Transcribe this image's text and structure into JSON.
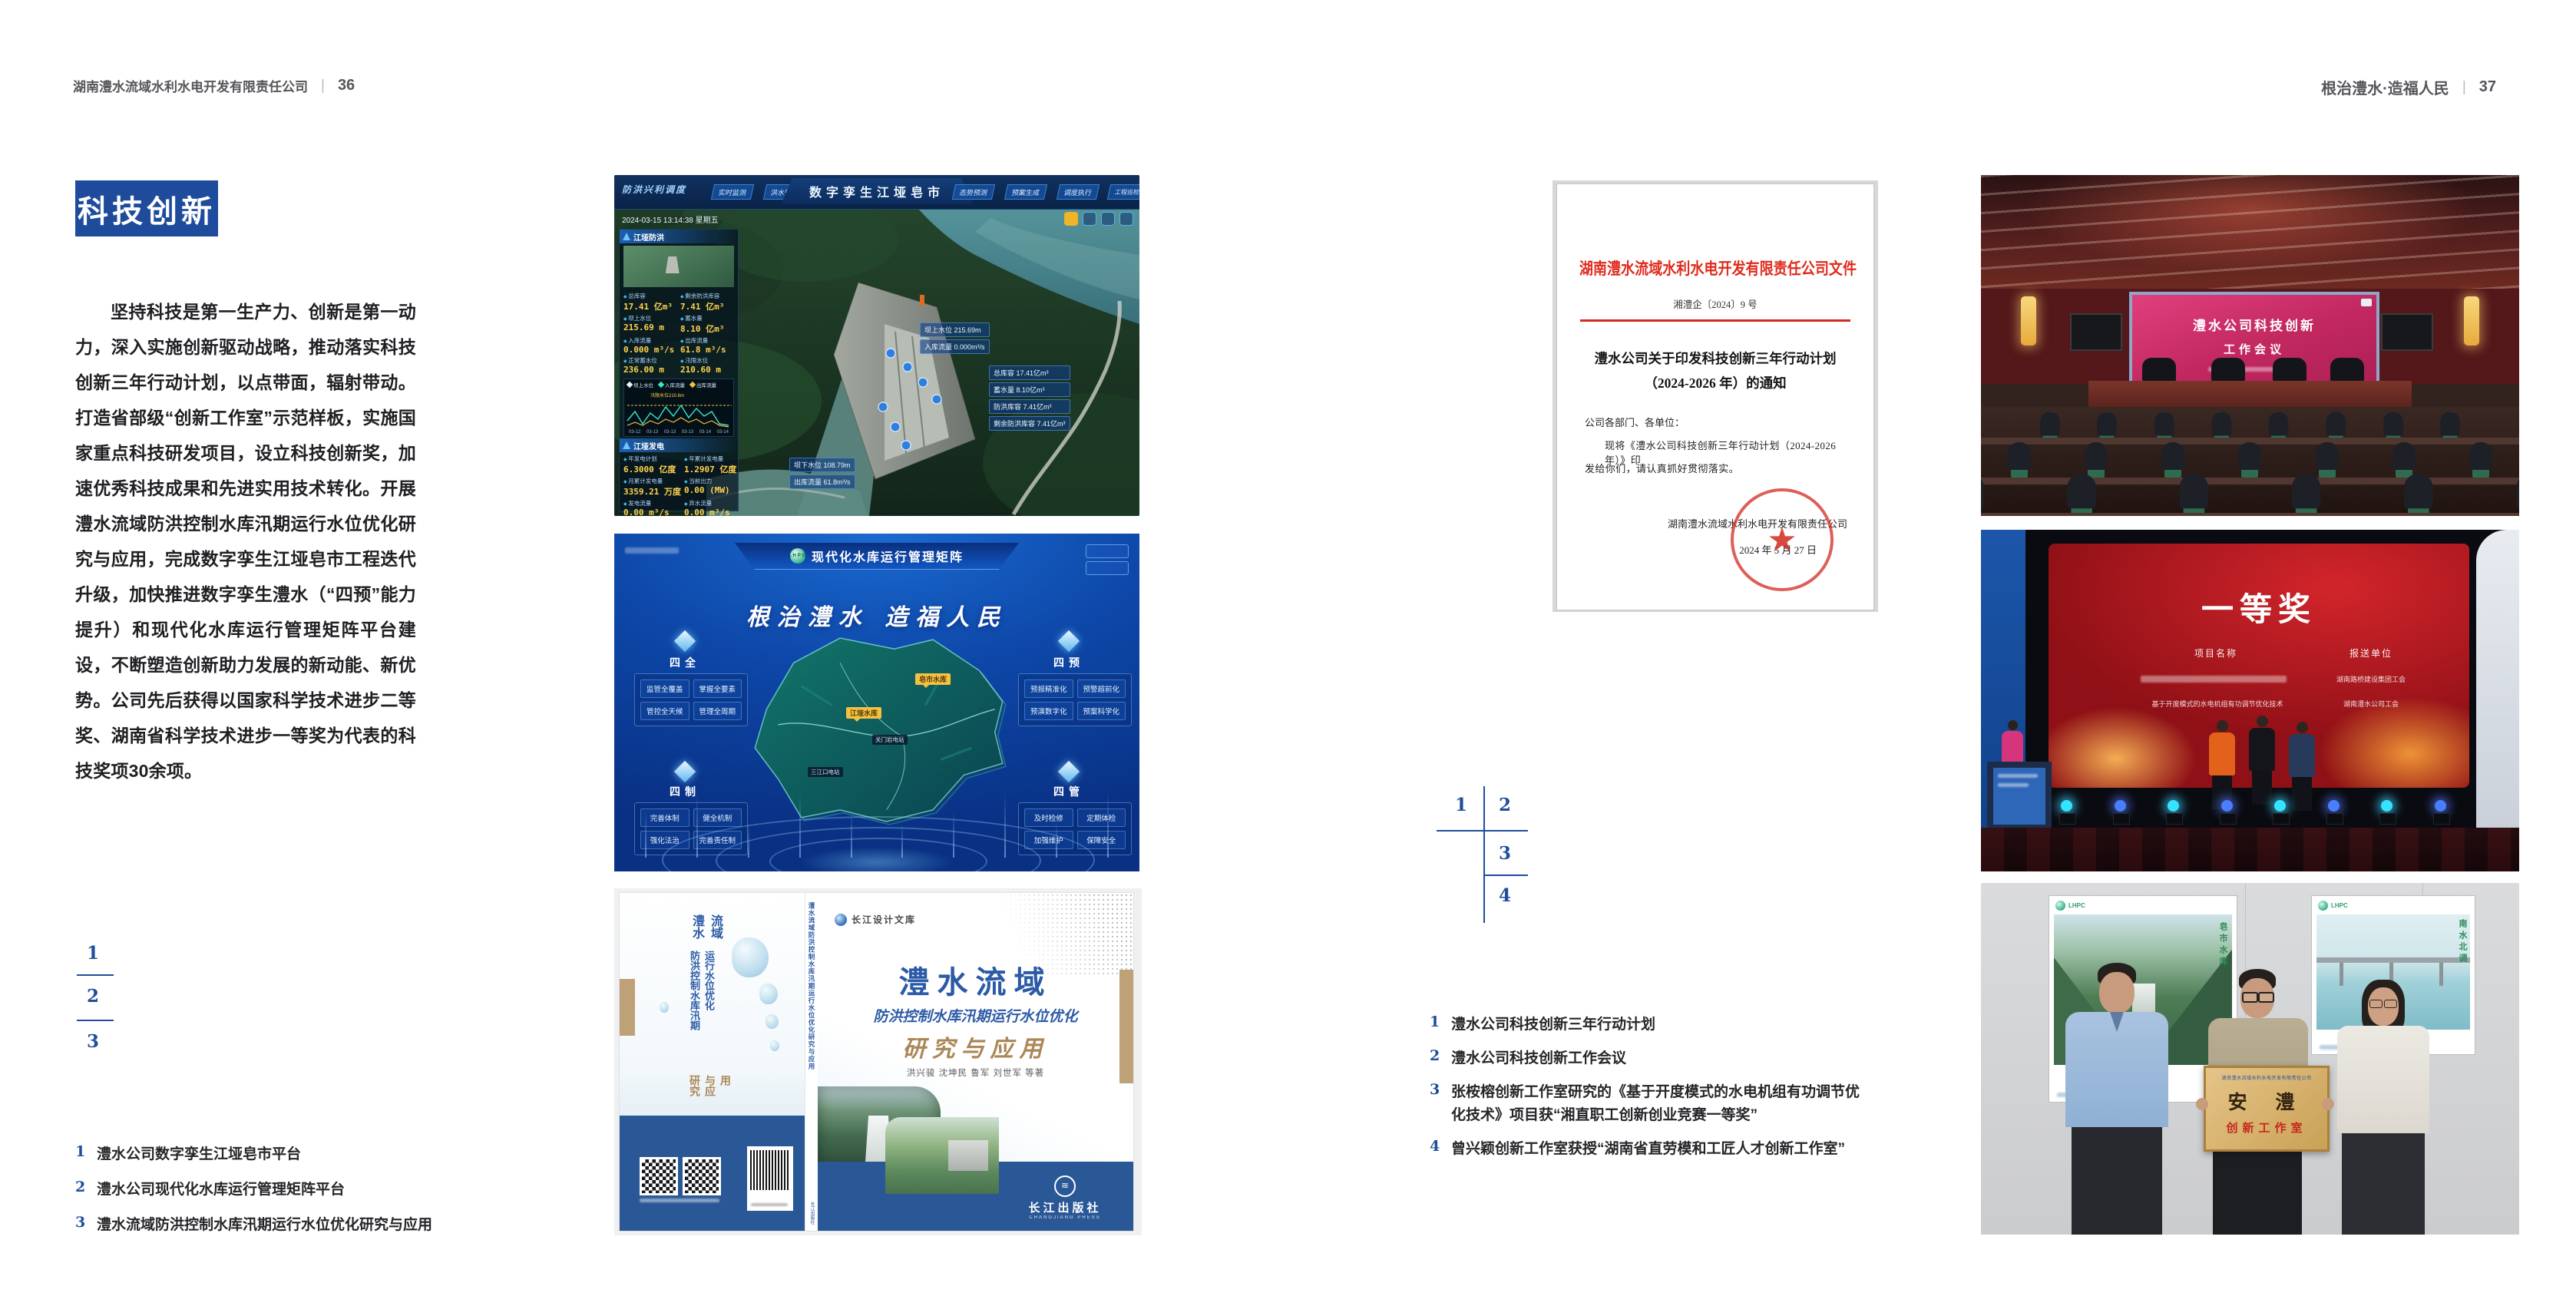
{
  "colors": {
    "accent_blue": "#1e4b9c",
    "index_blue": "#1f4e9a",
    "doc_red": "#d5281e",
    "book_tan": "#ab8757"
  },
  "header": {
    "left_company": "湖南澧水流域水利水电开发有限责任公司",
    "left_page_no": "36",
    "divider": "|",
    "right_slogan": "根治澧水·造福人民",
    "right_page_no": "37"
  },
  "section": {
    "title": "科技创新",
    "body": "坚持科技是第一生产力、创新是第一动力，深入实施创新驱动战略，推动落实科技创新三年行动计划，以点带面，辐射带动。打造省部级“创新工作室”示范样板，实施国家重点科技研发项目，设立科技创新奖，加速优秀科技成果和先进实用技术转化。开展澧水流域防洪控制水库汛期运行水位优化研究与应用，完成数字孪生江垭皂市工程迭代升级，加快推进数字孪生澧水（“四预”能力提升）和现代化水库运行管理矩阵平台建设，不断塑造创新助力发展的新动能、新优势。公司先后获得以国家科学技术进步二等奖、湖南省科学技术进步一等奖为代表的科技奖项30余项。"
  },
  "left_index": {
    "n1": "1",
    "n2": "2",
    "n3": "3"
  },
  "right_index": {
    "n1": "1",
    "n2": "2",
    "n3": "3",
    "n4": "4"
  },
  "left_captions": [
    {
      "no": "1",
      "text": "澧水公司数字孪生江垭皂市平台"
    },
    {
      "no": "2",
      "text": "澧水公司现代化水库运行管理矩阵平台"
    },
    {
      "no": "3",
      "text": "澧水流域防洪控制水库汛期运行水位优化研究与应用"
    }
  ],
  "right_captions": [
    {
      "no": "1",
      "text": "澧水公司科技创新三年行动计划"
    },
    {
      "no": "2",
      "text": "澧水公司科技创新工作会议"
    },
    {
      "no": "3",
      "text": "张桉榕创新工作室研究的《基于开度模式的水电机组有功调节优化技术》项目获“湘直职工创新创业竞赛一等奖”"
    },
    {
      "no": "4",
      "text": "曾兴颖创新工作室获授“湖南省直劳模和工匠人才创新工作室”"
    }
  ],
  "dashboard": {
    "corner_label": "防洪兴利调度",
    "tabs_left": [
      "实时监测",
      "洪水预报",
      "防洪预警"
    ],
    "title": "数字孪生江垭皂市",
    "tabs_right": [
      "态势预测",
      "预案生成",
      "调度执行",
      "工程巡检"
    ],
    "timestamp": "2024-03-15 13:14:38 星期五",
    "flood_title": "江垭防洪",
    "flood_stats": [
      {
        "label": "总库容",
        "value": "17.41 亿m³"
      },
      {
        "label": "剩余防洪库容",
        "value": "7.41 亿m³"
      },
      {
        "label": "坝上水位",
        "value": "215.69 m"
      },
      {
        "label": "蓄水量",
        "value": "8.10 亿m³"
      },
      {
        "label": "入库流量",
        "value": "0.000 m³/s"
      },
      {
        "label": "出库流量",
        "value": "61.8 m³/s"
      },
      {
        "label": "正常蓄水位",
        "value": "236.00 m"
      },
      {
        "label": "汛限水位",
        "value": "210.60 m"
      }
    ],
    "legend": [
      "坝上水位",
      "入库流量",
      "出库流量"
    ],
    "limit_note": "汛限水位210.6m",
    "x_ticks": [
      "03-12",
      "03-13",
      "03-13",
      "03-13",
      "03-14",
      "03-14"
    ],
    "power_title": "江垭发电",
    "power_stats": [
      {
        "label": "年发电计划",
        "value": "6.3000 亿度"
      },
      {
        "label": "年累计发电量",
        "value": "1.2907 亿度"
      },
      {
        "label": "月累计发电量",
        "value": "3359.21 万度"
      },
      {
        "label": "当前出力",
        "value": "0.00 (MW)"
      },
      {
        "label": "发电流量",
        "value": "0.00 m³/s"
      },
      {
        "label": "弃水流量",
        "value": "0.00 m³/s"
      }
    ],
    "gauges": [
      "0.00",
      "100.98",
      "0.00"
    ],
    "callout_up": [
      "坝上水位 215.69m",
      "入库流量 0.000m³/s"
    ],
    "callout_res": [
      "总库容 17.41亿m³",
      "蓄水量 8.10亿m³",
      "防洪库容 7.41亿m³",
      "剩余防洪库容 7.41亿m³"
    ],
    "callout_down": [
      "坝下水位 108.79m",
      "出库流量 61.8m³/s"
    ]
  },
  "matrix": {
    "logo": "LHPC",
    "title": "现代化水库运行管理矩阵",
    "slogan": "根治澧水 造福人民",
    "panels": [
      {
        "name": "四全",
        "items": [
          "监管全覆盖",
          "掌握全要素",
          "管控全天候",
          "管理全周期"
        ]
      },
      {
        "name": "四预",
        "items": [
          "预报精准化",
          "预警超前化",
          "预演数字化",
          "预案科学化"
        ]
      },
      {
        "name": "四制",
        "items": [
          "完善体制",
          "健全机制",
          "强化法治",
          "完善责任制"
        ]
      },
      {
        "name": "四管",
        "items": [
          "及时检修",
          "定期体检",
          "加强维护",
          "保障安全"
        ]
      }
    ],
    "markers": [
      "皂市水库",
      "江垭水库",
      "关门岩电站",
      "三江口电站"
    ]
  },
  "book": {
    "series": "长江设计文库",
    "title1": "澧水流域",
    "title2": "防洪控制水库汛期运行水位优化",
    "title3": "研究与应用",
    "authors": "洪兴骏  沈坤民  鲁军  刘世军  等著",
    "publisher": "长江出版社",
    "publisher_en": "CHANGJIANG PRESS",
    "spine_title": "澧水流域防洪控制水库汛期运行水位优化研究与应用",
    "back_title1": "澧水流域",
    "back_title2": "防洪控制水库汛期运行水位优化",
    "back_title3": "研究与应用"
  },
  "document": {
    "header": "湖南澧水流域水利水电开发有限责任公司文件",
    "doc_no": "湘澧企〔2024〕9 号",
    "title1": "澧水公司关于印发科技创新三年行动计划",
    "title2": "（2024-2026 年）的通知",
    "salutation": "公司各部门、各单位：",
    "body1": "现将《澧水公司科技创新三年行动计划（2024-2026 年）》印",
    "body2": "发给你们，请认真抓好贯彻落实。",
    "signer": "湖南澧水流域水利水电开发有限责任公司",
    "date": "2024 年 5 月 27 日",
    "seal_star": "★"
  },
  "meeting": {
    "screen_line1": "澧水公司科技创新",
    "screen_line2": "工作会议"
  },
  "award": {
    "title": "一等奖",
    "col1_header": "项目名称",
    "col2_header": "报送单位",
    "project2": "基于开度模式的水电机组有功调节优化技术",
    "org1": "湖南路桥建设集团工会",
    "org2": "湖南澧水公司工会"
  },
  "plaque": {
    "logo": "LHPC",
    "header": "湖南澧水流域水利水电开发有限责任公司",
    "big_text": "安  澧",
    "sub_text": "创新工作室",
    "poster_left_caption": "皂市水库",
    "poster_right_caption": "南水北调"
  }
}
